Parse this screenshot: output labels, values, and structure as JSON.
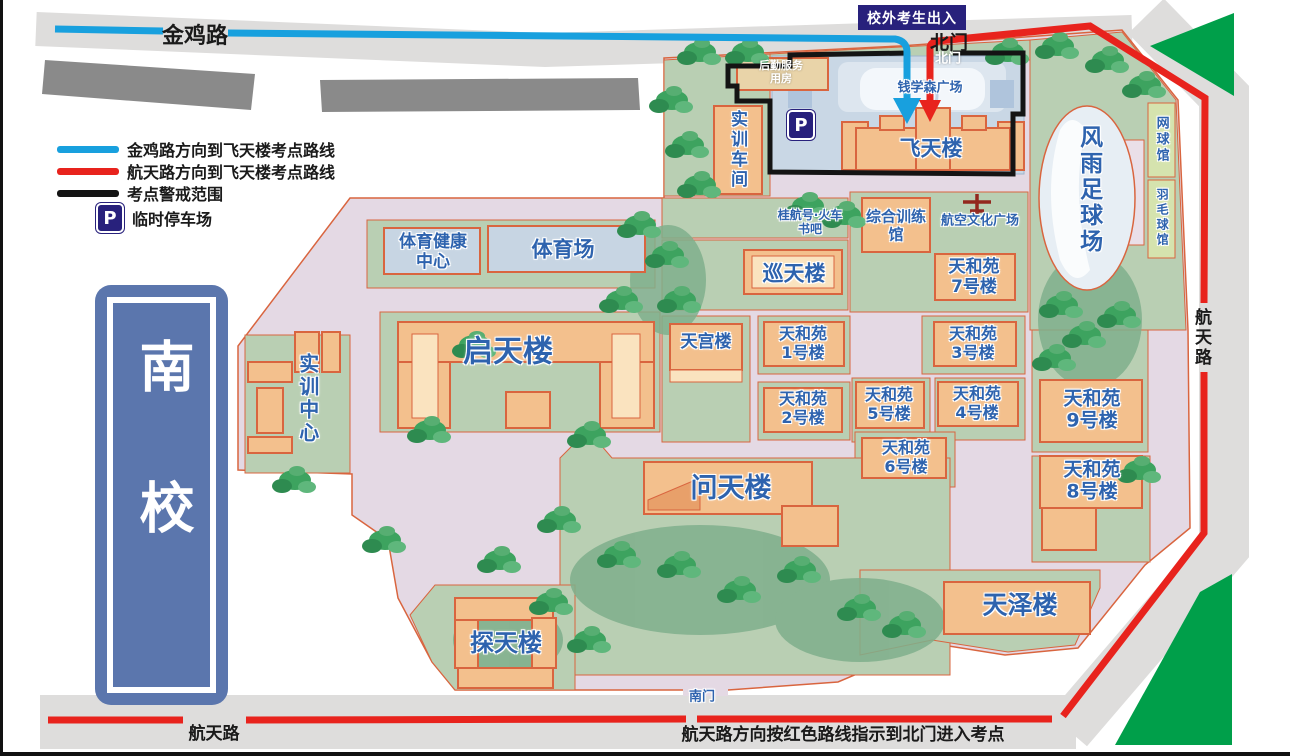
{
  "roads": {
    "jinji": "金鸡路",
    "hangtian_right": "航天路",
    "hangtian_bottom": "航天路"
  },
  "legend": {
    "items": [
      {
        "label": "金鸡路方向到飞天楼考点路线",
        "color": "#18A0DE"
      },
      {
        "label": "航天路方向到飞天楼考点路线",
        "color": "#E8231D"
      },
      {
        "label": "考点警戒范围",
        "color": "#141414"
      },
      {
        "label": "临时停车场",
        "color": "#28217C"
      }
    ]
  },
  "parking_symbol": "P",
  "banner": "校外考生出入",
  "instruction": "航天路方向按红色路线指示到北门进入考点",
  "campus_sign": "南校",
  "gates": {
    "north": "北门",
    "north_inner": "北门",
    "south": "南门"
  },
  "places": {
    "houqin": "后勤服务\n用房",
    "shixun_chejian": "实训车间",
    "qianxuesen_square": "钱学森广场",
    "feitian": "飞天楼",
    "fengyu": "风雨足球场",
    "wangqiu": "网球馆",
    "yumaoqiu": "羽毛球馆",
    "guihang": "桂航号·火车\n书吧",
    "zonghe": "综合训练\n馆",
    "hangkong_square": "航空文化广场",
    "xuntian": "巡天楼",
    "tianhe7": "天和苑\n7号楼",
    "tiyu_jiankang": "体育健康\n中心",
    "tiyuchang": "体育场",
    "qitian": "启天楼",
    "shixun_center": "实训中心",
    "tiangong": "天宫楼",
    "tianhe1": "天和苑\n1号楼",
    "tianhe2": "天和苑\n2号楼",
    "tianhe3": "天和苑\n3号楼",
    "tianhe4": "天和苑\n4号楼",
    "tianhe5": "天和苑\n5号楼",
    "tianhe6": "天和苑\n6号楼",
    "tianhe8": "天和苑\n8号楼",
    "tianhe9": "天和苑\n9号楼",
    "wentian": "问天楼",
    "tantian": "探天楼",
    "tianze": "天泽楼"
  },
  "colors": {
    "route_blue": "#18A0DE",
    "route_red": "#E8231D",
    "boundary_black": "#141414",
    "building_fill": "#F3C08D",
    "building_border": "#D9653F",
    "ground_pink": "#E4D9E4",
    "green_block": "#B9CFB3",
    "road_gray": "#DEDDDC",
    "label_blue": "#2E63AE",
    "sign_blue": "#5B76AD",
    "navy_badge": "#28217C",
    "roadside_green": "#009F4A"
  }
}
